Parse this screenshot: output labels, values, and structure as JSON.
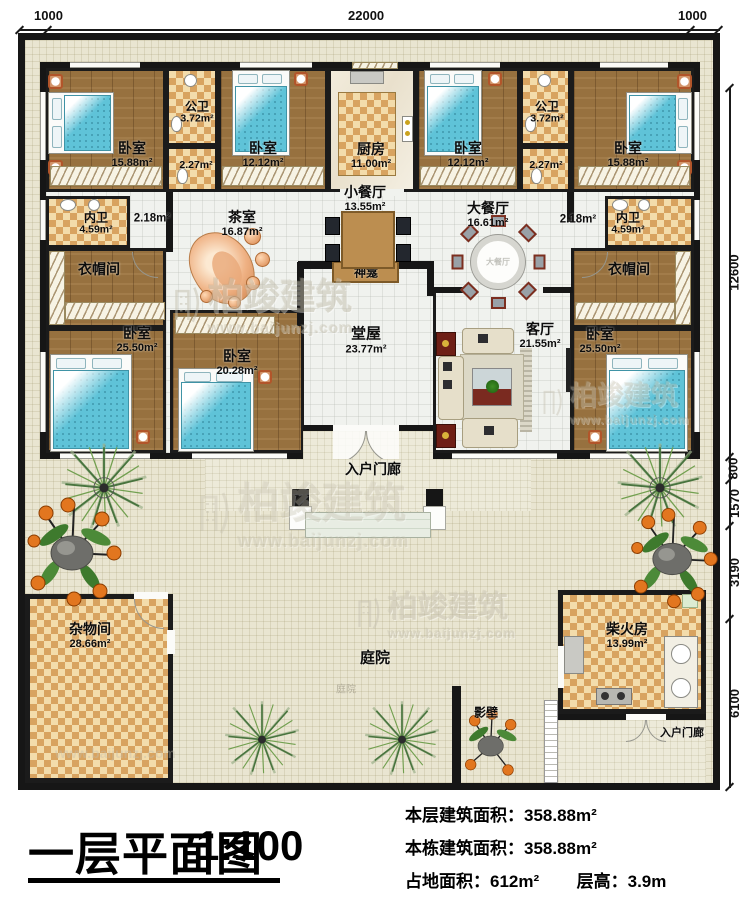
{
  "dimensions": {
    "top": [
      "1000",
      "22000",
      "1000"
    ],
    "right": [
      "12600",
      "800",
      "1570",
      "3190",
      "6100"
    ]
  },
  "rooms": {
    "bedroom_top_left": {
      "name": "卧室",
      "area": "15.88m²"
    },
    "public_bath_left": {
      "name": "公卫",
      "area": "3.72m²"
    },
    "public_bath_left_lobby": {
      "area": "2.27m²"
    },
    "bedroom_top_2": {
      "name": "卧室",
      "area": "12.12m²"
    },
    "kitchen": {
      "name": "厨房",
      "area": "11.00m²"
    },
    "bedroom_top_3": {
      "name": "卧室",
      "area": "12.12m²"
    },
    "public_bath_right": {
      "name": "公卫",
      "area": "3.72m²"
    },
    "public_bath_right_lobby": {
      "area": "2.27m²"
    },
    "bedroom_top_right": {
      "name": "卧室",
      "area": "15.88m²"
    },
    "ensuite_left": {
      "name": "内卫",
      "area": "4.59m²"
    },
    "corridor_left": {
      "area": "2.18m²"
    },
    "tea_room": {
      "name": "茶室",
      "area": "16.87m²"
    },
    "small_dining": {
      "name": "小餐厅",
      "area": "13.55m²"
    },
    "large_dining": {
      "name": "大餐厅",
      "area": "16.61m²"
    },
    "corridor_right": {
      "area": "2.18m²"
    },
    "ensuite_right": {
      "name": "内卫",
      "area": "4.59m²"
    },
    "cloakroom_left": {
      "name": "衣帽间"
    },
    "cloakroom_right": {
      "name": "衣帽间"
    },
    "bedroom_left": {
      "name": "卧室",
      "area": "25.50m²"
    },
    "bedroom_center": {
      "name": "卧室",
      "area": "20.28m²"
    },
    "main_hall": {
      "name": "堂屋",
      "area": "23.77m²"
    },
    "living_room": {
      "name": "客厅",
      "area": "21.55m²"
    },
    "bedroom_right": {
      "name": "卧室",
      "area": "25.50m²"
    },
    "altar": {
      "name": "神龛"
    },
    "entry_porch_front": {
      "name": "入户门廊"
    },
    "storage": {
      "name": "杂物间",
      "area": "28.66m²"
    },
    "courtyard": {
      "name": "庭院"
    },
    "courtyard_faint": {
      "name": "庭院"
    },
    "firewood_room": {
      "name": "柴火房",
      "area": "13.99m²"
    },
    "screen_wall": {
      "name": "影壁"
    },
    "entry_porch_side": {
      "name": "入户门廊"
    },
    "large_dining_table_text": "大餐厅"
  },
  "title_block": {
    "title": "一层平面图",
    "scale": "1:100",
    "stats": [
      {
        "label": "本层建筑面积：",
        "value": "358.88m²"
      },
      {
        "label": "本栋建筑面积：",
        "value": "358.88m²"
      },
      {
        "label": "占地面积：",
        "value": "612m²"
      },
      {
        "label": "层高：",
        "value": "3.9m"
      }
    ]
  },
  "watermark": {
    "name": "柏竣建筑",
    "url": "www.baijunzj.com"
  },
  "colors": {
    "wall": "#161616",
    "wood_floor": "#97713f",
    "checker_dark": "#d8a360",
    "checker_light": "#f3dcab",
    "bed_blue": "#5fc3d8",
    "hall_floor": "#f0f2ee",
    "courtyard": "#e9e5d1",
    "accent_red": "#7c2e1f"
  }
}
